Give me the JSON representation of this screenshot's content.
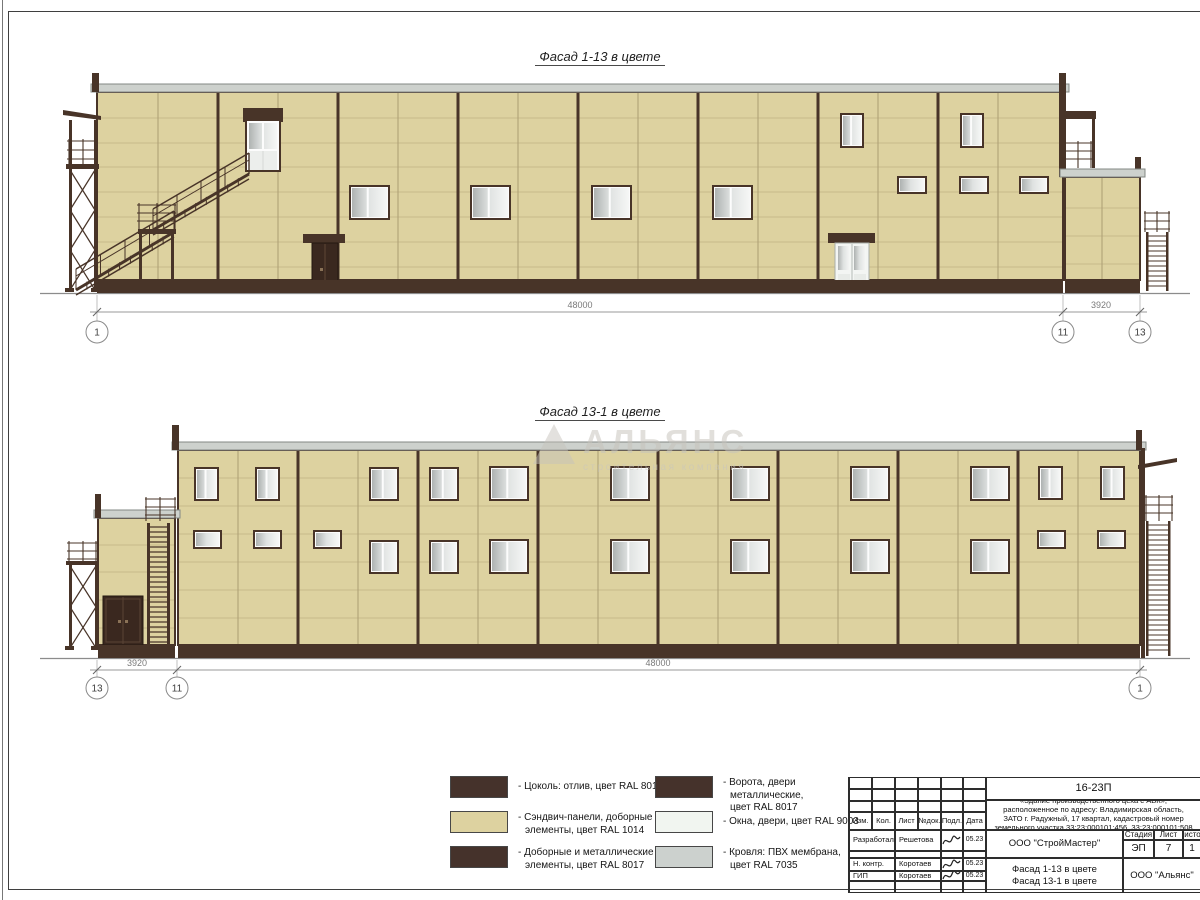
{
  "sheet": {
    "code": "16-23П"
  },
  "facades": [
    {
      "title": "Фасад 1-13 в цвете",
      "dims": [
        {
          "label": "48000"
        },
        {
          "label": "3920"
        }
      ],
      "axes": [
        "1",
        "11",
        "13"
      ],
      "windows": [
        [
          352,
          188,
          35,
          29,
          "win"
        ],
        [
          473,
          188,
          35,
          29,
          "win"
        ],
        [
          594,
          188,
          35,
          29,
          "win"
        ],
        [
          715,
          188,
          35,
          29,
          "win"
        ],
        [
          843,
          116,
          18,
          29,
          "win"
        ],
        [
          963,
          116,
          18,
          29,
          "win"
        ],
        [
          900,
          179,
          24,
          12,
          "vent"
        ],
        [
          962,
          179,
          24,
          12,
          "vent"
        ],
        [
          1022,
          179,
          24,
          12,
          "vent"
        ],
        [
          1088,
          188,
          29,
          28,
          "win"
        ],
        [
          1088,
          247,
          29,
          28,
          "win"
        ]
      ]
    },
    {
      "title": "Фасад 13-1 в цвете",
      "dims": [
        {
          "label": "3920"
        },
        {
          "label": "48000"
        }
      ],
      "axes": [
        "13",
        "11",
        "1"
      ],
      "windows": [
        [
          197,
          470,
          19,
          28,
          "win"
        ],
        [
          258,
          470,
          19,
          28,
          "win"
        ],
        [
          196,
          533,
          23,
          13,
          "vent"
        ],
        [
          256,
          533,
          23,
          13,
          "vent"
        ],
        [
          316,
          533,
          23,
          13,
          "vent"
        ],
        [
          372,
          470,
          24,
          28,
          "win"
        ],
        [
          432,
          470,
          24,
          28,
          "win"
        ],
        [
          372,
          543,
          24,
          28,
          "win"
        ],
        [
          432,
          543,
          24,
          28,
          "win"
        ],
        [
          492,
          469,
          34,
          29,
          "win"
        ],
        [
          613,
          469,
          34,
          29,
          "win"
        ],
        [
          733,
          469,
          34,
          29,
          "win"
        ],
        [
          853,
          469,
          34,
          29,
          "win"
        ],
        [
          973,
          469,
          34,
          29,
          "win"
        ],
        [
          492,
          542,
          34,
          29,
          "win"
        ],
        [
          613,
          542,
          34,
          29,
          "win"
        ],
        [
          733,
          542,
          34,
          29,
          "win"
        ],
        [
          853,
          542,
          34,
          29,
          "win"
        ],
        [
          973,
          542,
          34,
          29,
          "win"
        ],
        [
          1041,
          469,
          19,
          28,
          "win"
        ],
        [
          1103,
          469,
          19,
          28,
          "win"
        ],
        [
          1040,
          533,
          23,
          13,
          "vent"
        ],
        [
          1100,
          533,
          23,
          13,
          "vent"
        ]
      ]
    }
  ],
  "legend": {
    "items": [
      {
        "color": "#45322b",
        "label": "- Цоколь: отлив, цвет RAL 8017"
      },
      {
        "color": "#ddd2a0",
        "label": "- Сэндвич-панели, доборные\nэлементы, цвет RAL 1014"
      },
      {
        "color": "#45322b",
        "label": "- Доборные и металлические\nэлементы, цвет RAL 8017"
      },
      {
        "color": "#45322b",
        "label": "- Ворота, двери металлические,\nцвет RAL 8017"
      },
      {
        "color": "#f1f5f0",
        "label": "- Окна, двери, цвет RAL 9003"
      },
      {
        "color": "#ccd1ce",
        "label": "- Кровля: ПВХ мембрана,\nцвет RAL 7035"
      }
    ]
  },
  "titleblock": {
    "doc_number": "16-23П",
    "object_description": "«Здание производственного цеха с АБК»,\nрасположенное по адресу: Владимирская область,\nЗАТО г. Радужный, 17 квартал, кадастровый номер\nземельного участка 33:23:000101:456, 33:23:000101:508",
    "header_cols": [
      "Изм.",
      "Кол.",
      "Лист",
      "№док.",
      "Подл.",
      "Дата"
    ],
    "rows": [
      {
        "role": "Разработал",
        "name": "Решетова",
        "date": "05.23"
      },
      {
        "role": "Н. контр.",
        "name": "Коротаев",
        "date": "05.23"
      },
      {
        "role": "ГИП",
        "name": "Коротаев",
        "date": "05.23"
      }
    ],
    "org1": "ООО \"СтройМастер\"",
    "stage_label": "Стадия",
    "sheet_label": "Лист",
    "sheets_label": "Листов",
    "stage": "ЭП",
    "sheet": "7",
    "sheets": "1",
    "drawing_title": "Фасад 1-13 в цвете\nФасад 13-1 в цвете",
    "org2": "ООО \"Альянс\""
  },
  "watermark": {
    "line1": "АЛЬЯНС",
    "line2": "строительная компания"
  },
  "colors": {
    "panel": "#ddd2a0",
    "panel_joint": "#c6b98a",
    "seam_minor": "#b3a67a",
    "brown": "#483428",
    "door_dark": "#3a281f",
    "coping": "#cdd1cd",
    "coping_edge": "#838884",
    "dim_line": "#9a9a9a",
    "dim_text": "#7a7a7a",
    "ground": "#8c8c8c"
  }
}
